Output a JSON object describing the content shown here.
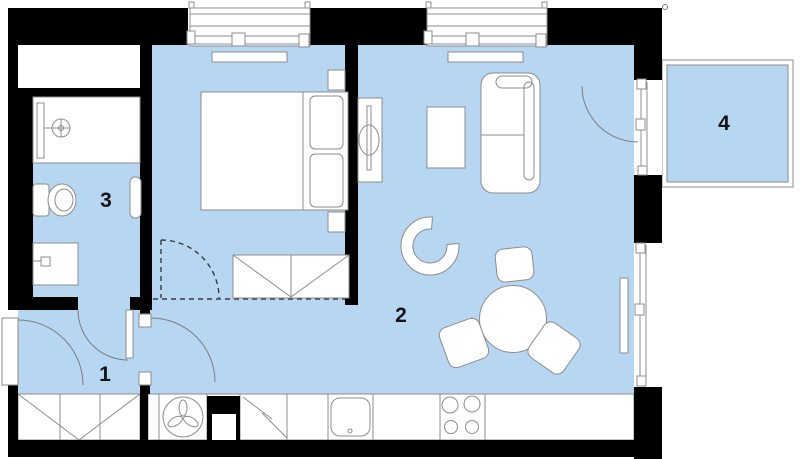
{
  "title": "apartment-floor-plan",
  "rooms": [
    {
      "id": "entrance-hall",
      "label": "1"
    },
    {
      "id": "living-room-kitchen",
      "label": "2"
    },
    {
      "id": "bathroom",
      "label": "3"
    },
    {
      "id": "balcony",
      "label": "4"
    }
  ],
  "colors": {
    "floor": "#b7d6f2",
    "wall": "#000000",
    "outline": "#8c8c8c",
    "winline": "#8f8f8f",
    "dash": "#3a3a3a",
    "background": "#ffffff",
    "label": "#141414"
  }
}
